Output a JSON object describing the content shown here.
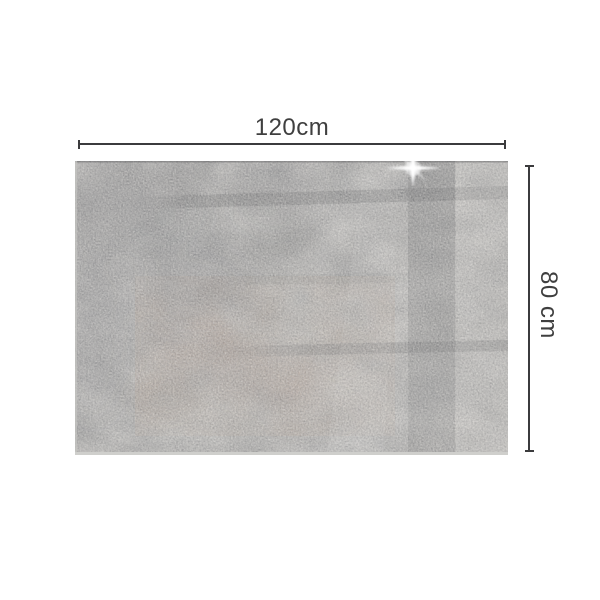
{
  "page": {
    "background": "#ffffff"
  },
  "dimensions": {
    "width_label": "120cm",
    "height_label": "80 cm"
  },
  "icons": {
    "sparkle_highlight": "4-point-star-glare"
  },
  "style_colors": {
    "dimension_line": "#3b3b3d",
    "label_text": "#3f3f3f",
    "board_base_gray": "#8f8e8b",
    "board_dark_gray": "#6f7073",
    "board_light_gray": "#a3a19c",
    "rust_tint": "#8a6b57",
    "glass_edge": "#cfcfcc",
    "reflection_dark": "#35373a"
  }
}
